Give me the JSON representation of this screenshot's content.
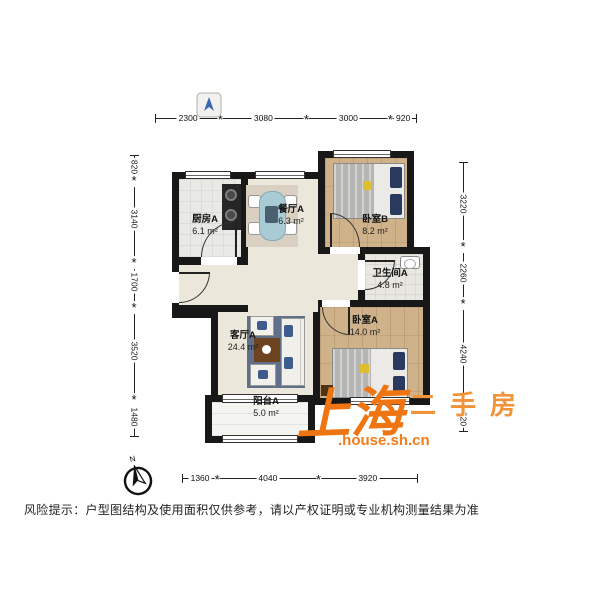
{
  "plan": {
    "rooms": [
      {
        "name": "厨房A",
        "area": "6.1 m²"
      },
      {
        "name": "餐厅A",
        "area": "6.3 m²"
      },
      {
        "name": "卧室B",
        "area": "8.2 m²"
      },
      {
        "name": "卫生间A",
        "area": "4.8 m²"
      },
      {
        "name": "客厅A",
        "area": "24.4 m²"
      },
      {
        "name": "卧室A",
        "area": "14.0 m²"
      },
      {
        "name": "阳台A",
        "area": "5.0 m²"
      }
    ],
    "dimensions": {
      "top": [
        "2300",
        "3080",
        "3000",
        "920"
      ],
      "left": [
        "820",
        "3140",
        "1700",
        "3520",
        "1480"
      ],
      "right": [
        "3220",
        "2260",
        "4240",
        "920"
      ],
      "bottom": [
        "1360",
        "4040",
        "3920"
      ]
    },
    "compass_label": "N"
  },
  "watermark": {
    "brand": "上海",
    "brand2": "二手房",
    "site": ".house.sh.cn",
    "color_main": "#ee7512",
    "color_light": "#f29339"
  },
  "disclaimer": "风险提示：户型图结构及使用面积仅供参考，请以产权证明或专业机构测量结果为准"
}
